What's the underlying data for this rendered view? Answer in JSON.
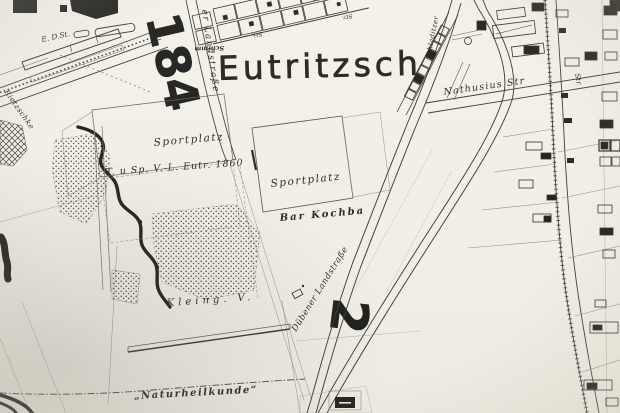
{
  "map": {
    "title": "Eutritzsch",
    "sheet_numbers": {
      "large": "184",
      "small": "2"
    },
    "labels": {
      "sportplatz_west": "Sportplatz",
      "sportplatz_east": "Sportplatz",
      "club_1860": "T. u Sp. V.-L. Eutr. 1860",
      "bar_kochba": "Bar Kochba",
      "kleingarten": "Kleing. V.",
      "naturheilkunde": "„Naturheilkunde“",
      "landstrasse_north": "er Landstraße",
      "duebener_landstrasse": "Dübener Landstraße",
      "nathusius_str": "Nathusius Str",
      "schladitzer": "Schladitzer",
      "str_right": "Str",
      "str_plot_a": "Str.",
      "str_plot_b": "Str.",
      "plots_name": "Schimm",
      "stream": "Rietzschke",
      "station": "E. D.St."
    },
    "colors": {
      "paper": "#f2efe7",
      "ink": "#16140f",
      "faint_line": "#6b665c"
    }
  }
}
